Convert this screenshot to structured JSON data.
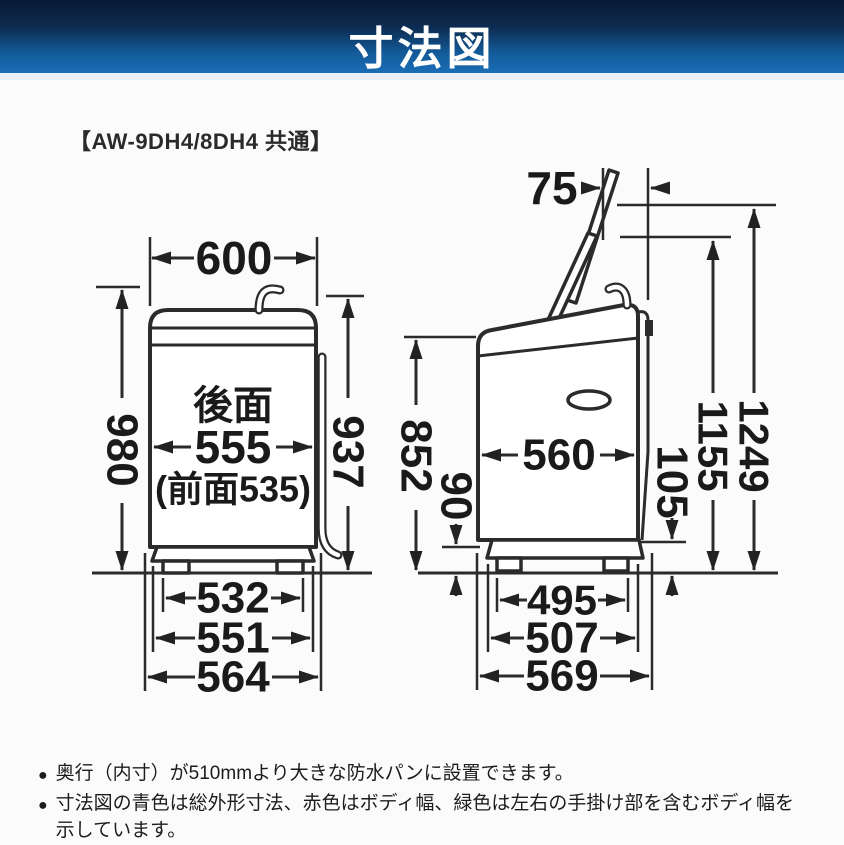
{
  "header": {
    "title": "寸法図"
  },
  "model_label": "【AW-9DH4/8DH4 共通】",
  "colors": {
    "blue": "#1f7ec2",
    "red": "#cc2222",
    "green": "#15a257",
    "black": "#1a1a1a"
  },
  "front_view": {
    "overall_width": "600",
    "overall_height": "980",
    "body_height": "937",
    "rear_label": "後面",
    "body_width_rear": "555",
    "body_width_front": "(前面535)",
    "feet_span": "532",
    "base_width": "551",
    "handle_width": "564"
  },
  "side_view": {
    "lid_overhang": "75",
    "front_height": "852",
    "base_height": "90",
    "body_depth": "560",
    "rear_clearance": "105",
    "lid_open_inner_height": "1155",
    "lid_open_height": "1249",
    "feet_span": "495",
    "base_depth": "507",
    "overall_depth": "569"
  },
  "notes": [
    {
      "bullet": "●",
      "lines": [
        "奥行（内寸）が510mmより大きな防水パンに設置できます。",
        ""
      ]
    },
    {
      "bullet": "●",
      "lines": [
        "寸法図の青色は総外形寸法、赤色はボディ幅、緑色は左右の手掛け部を含むボディ幅を",
        "示しています。"
      ]
    }
  ]
}
